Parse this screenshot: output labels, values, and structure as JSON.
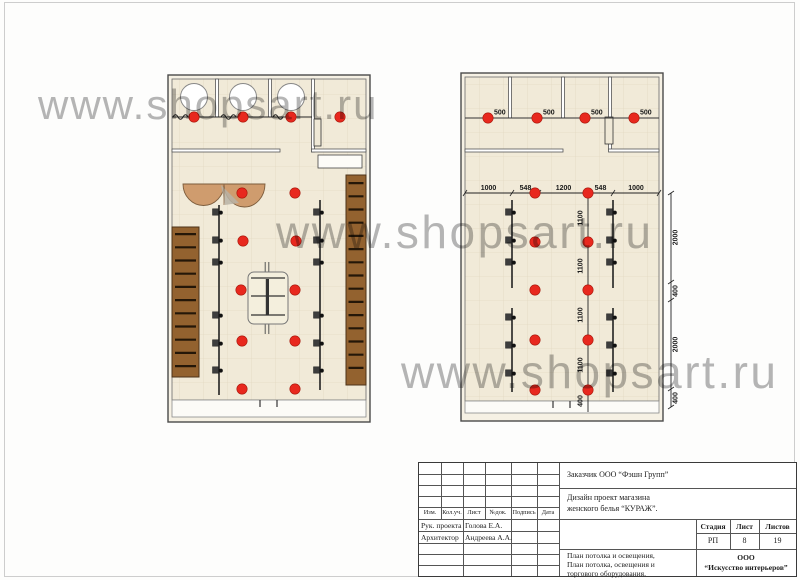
{
  "watermark": {
    "text": "www.shopsart.ru"
  },
  "colors": {
    "floor": "#f1ead8",
    "tile_line": "#e3d9c2",
    "wall": "#4a4a4a",
    "wall_band": "#f6f1e4",
    "light_red": "#e8281e",
    "shelf_brown": "#93622f",
    "desk_tan": "#cf9c6e",
    "track": "#222222"
  },
  "plans": {
    "left": {
      "description": "ceiling + lighting + trade equipment plan",
      "lights": [
        [
          39,
          47
        ],
        [
          88,
          47
        ],
        [
          136,
          47
        ],
        [
          185,
          47
        ],
        [
          87,
          123
        ],
        [
          140,
          123
        ],
        [
          88,
          171
        ],
        [
          141,
          171
        ],
        [
          86,
          220
        ],
        [
          140,
          220
        ],
        [
          87,
          271
        ],
        [
          140,
          271
        ],
        [
          87,
          319
        ],
        [
          140,
          319
        ]
      ]
    },
    "right": {
      "description": "ceiling and lighting plan with dimensions",
      "lights_500": [
        [
          33,
          58
        ],
        [
          82,
          58
        ],
        [
          130,
          58
        ],
        [
          179,
          58
        ]
      ],
      "labels_500": [
        "500",
        "500",
        "500",
        "500"
      ],
      "lights_grid": [
        [
          80,
          133
        ],
        [
          133,
          133
        ],
        [
          80,
          182
        ],
        [
          133,
          182
        ],
        [
          80,
          230
        ],
        [
          133,
          230
        ],
        [
          80,
          280
        ],
        [
          133,
          280
        ],
        [
          80,
          330
        ],
        [
          133,
          330
        ]
      ],
      "dim_top": [
        "1000",
        "548",
        "1200",
        "548",
        "1000"
      ],
      "dim_mid": [
        "1100",
        "1100",
        "1100",
        "1100",
        "400"
      ],
      "dim_right": [
        "2000",
        "400",
        "2000",
        "400"
      ]
    }
  },
  "title_block": {
    "client": "Заказчик ООО “Фэшн Групп”",
    "project": [
      "Дизайн проект магазина",
      "женского белья “КУРАЖ”."
    ],
    "rev_headers": [
      "Изм.",
      "Кол.уч.",
      "Лист",
      "№док.",
      "Подпись",
      "Дата"
    ],
    "roles": [
      {
        "role": "Рук. проекта",
        "name": "Голова Е.А."
      },
      {
        "role": "Архитектор",
        "name": "Андреева А.А."
      }
    ],
    "stage": {
      "headers": [
        "Стадия",
        "Лист",
        "Листов"
      ],
      "stage": "РП",
      "sheet": "8",
      "sheets": "19"
    },
    "sheet_title": [
      "План потолка и освещения,",
      "План потолка, освещения и",
      "торгового оборудования."
    ],
    "company": [
      "ООО",
      "“Искусство интерьеров”"
    ]
  }
}
